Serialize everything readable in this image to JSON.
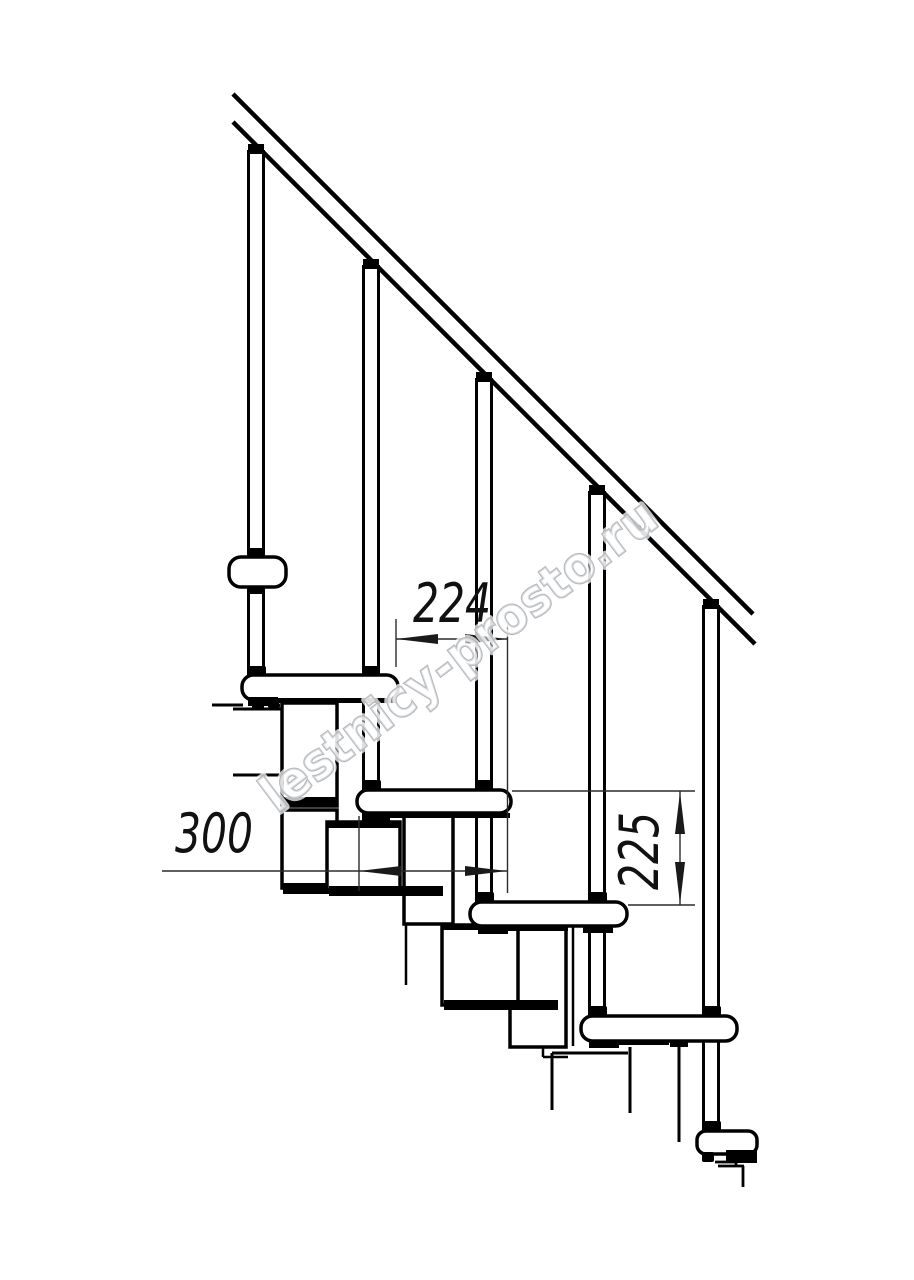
{
  "drawing": {
    "background_color": "#ffffff",
    "line_color": "#000000",
    "dimension_line_color": "#2b2b2b",
    "labels": {
      "run_between_steps": "224",
      "tread_depth": "300",
      "riser_height": "225"
    },
    "watermark": {
      "text": "lestnicy-prosto.ru",
      "outline_color": "#b4b8bd",
      "fill_color": "rgba(255,255,255,0.5)",
      "rotation_deg": -37
    },
    "counts": {
      "treads": 5,
      "balusters": 5
    }
  }
}
